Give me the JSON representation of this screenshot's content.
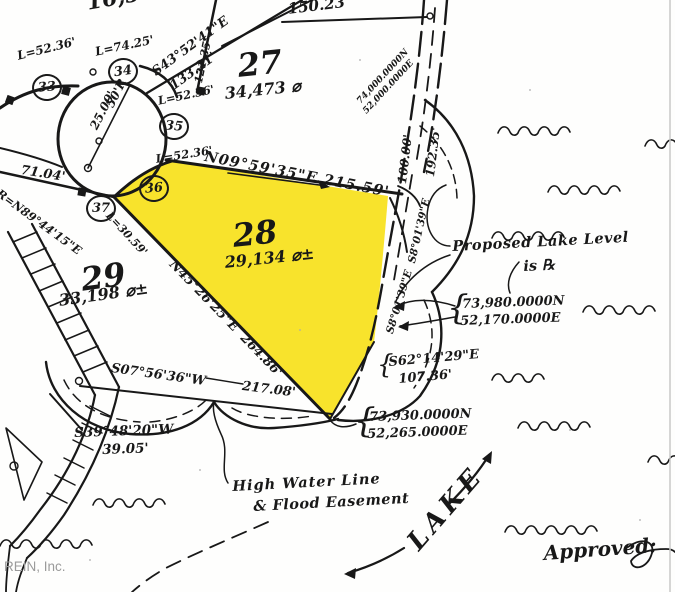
{
  "map": {
    "watermark": "REIN, Inc.",
    "colors": {
      "highlight": "#F8E32C",
      "ink": "#181818",
      "watermark": "#9b9b9b"
    },
    "corner_markers": [
      {
        "num": "33",
        "x": 32,
        "y": 74,
        "rot": -5
      },
      {
        "num": "34",
        "x": 108,
        "y": 58,
        "rot": -8
      },
      {
        "num": "35",
        "x": 159,
        "y": 113,
        "rot": 5
      },
      {
        "num": "36",
        "x": 139,
        "y": 175,
        "rot": -5
      },
      {
        "num": "37",
        "x": 86,
        "y": 195,
        "rot": 0
      }
    ],
    "labels": [
      {
        "name": "lot-area-16503",
        "text": "16,503 ⌀",
        "x": 85,
        "y": -8,
        "rot": -10,
        "size": 22
      },
      {
        "name": "dist-150-23",
        "text": "150.23'",
        "x": 287,
        "y": 2,
        "rot": -7,
        "size": 15
      },
      {
        "name": "lot-27-number",
        "text": "27",
        "x": 236,
        "y": 50,
        "rot": -6,
        "size": 32
      },
      {
        "name": "lot-27-area",
        "text": "34,473 ⌀",
        "x": 224,
        "y": 86,
        "rot": -6,
        "size": 16
      },
      {
        "name": "arc-l-52-36-a",
        "text": "L=52.36'",
        "x": 16,
        "y": 50,
        "rot": -14,
        "size": 12
      },
      {
        "name": "arc-l-74-25",
        "text": "L=74.25'",
        "x": 94,
        "y": 46,
        "rot": -12,
        "size": 12
      },
      {
        "name": "bearing-s43",
        "text": "S43°52'41\"E",
        "x": 150,
        "y": 68,
        "rot": -36,
        "size": 13
      },
      {
        "name": "dist-133-21",
        "text": "133.21'",
        "x": 168,
        "y": 82,
        "rot": -36,
        "size": 13
      },
      {
        "name": "arc-l-52-36-b",
        "text": "L=52.36'",
        "x": 157,
        "y": 96,
        "rot": -12,
        "size": 11.5
      },
      {
        "name": "radius-50r",
        "text": "50'R",
        "x": 104,
        "y": 104,
        "rot": -63,
        "size": 12
      },
      {
        "name": "dist-25-00",
        "text": "25.00'",
        "x": 88,
        "y": 126,
        "rot": -63,
        "size": 12
      },
      {
        "name": "arc-l-52-36-c",
        "text": "L=52.36'",
        "x": 155,
        "y": 154,
        "rot": -9,
        "size": 11.5
      },
      {
        "name": "bearing-n09",
        "text": "N09°59'35\"E 215.59'",
        "x": 206,
        "y": 150,
        "rot": 11,
        "size": 14.5,
        "ls": 1
      },
      {
        "name": "dist-71-04",
        "text": "71.04'",
        "x": 22,
        "y": 164,
        "rot": 9,
        "size": 13
      },
      {
        "name": "bearing-r-n89",
        "text": "R=N89°44'15\"E",
        "x": 1,
        "y": 188,
        "rot": 36,
        "size": 11.5
      },
      {
        "name": "arc-l-30-59",
        "text": "L=30.59'",
        "x": 112,
        "y": 210,
        "rot": 47,
        "size": 11
      },
      {
        "name": "lot-28-number",
        "text": "28",
        "x": 231,
        "y": 220,
        "rot": -6,
        "size": 32
      },
      {
        "name": "lot-28-area",
        "text": "29,134 ⌀±",
        "x": 224,
        "y": 255,
        "rot": -6,
        "size": 16
      },
      {
        "name": "lot-29-number",
        "text": "29",
        "x": 79,
        "y": 264,
        "rot": -8,
        "size": 32
      },
      {
        "name": "lot-29-area",
        "text": "33,198 ⌀±",
        "x": 58,
        "y": 293,
        "rot": -8,
        "size": 16
      },
      {
        "name": "bearing-n45",
        "text": "N45°26'25\"E  264.86'",
        "x": 176,
        "y": 258,
        "rot": 46,
        "size": 13
      },
      {
        "name": "dist-100-00",
        "text": "100.00'",
        "x": 396,
        "y": 183,
        "rot": -83,
        "size": 12
      },
      {
        "name": "dist-192-35",
        "text": "192.35'",
        "x": 424,
        "y": 176,
        "rot": -83,
        "size": 12
      },
      {
        "name": "bearing-s8-a",
        "text": "S8°01'39\"E",
        "x": 407,
        "y": 262,
        "rot": -77,
        "size": 10.5
      },
      {
        "name": "bearing-s8-b",
        "text": "S8°01'39\"E",
        "x": 385,
        "y": 332,
        "rot": -73,
        "size": 10.5
      },
      {
        "name": "coord-74000n",
        "text": "74,000.0000N",
        "x": 356,
        "y": 100,
        "rot": -47,
        "size": 9
      },
      {
        "name": "coord-52000e",
        "text": "52,000.0000E",
        "x": 362,
        "y": 110,
        "rot": -47,
        "size": 9
      },
      {
        "name": "dist-121-35",
        "text": "121.35'",
        "x": 193,
        "y": 82,
        "rot": -78,
        "size": 11
      },
      {
        "name": "note-proposed-lake-1",
        "text": "Proposed Lake Level",
        "x": 452,
        "y": 240,
        "rot": -3,
        "size": 14.5,
        "ls": 0.5
      },
      {
        "name": "note-proposed-lake-2",
        "text": "is ℞",
        "x": 523,
        "y": 260,
        "rot": -3,
        "size": 14.5
      },
      {
        "name": "brace-73980",
        "text": "{",
        "x": 447,
        "y": 291,
        "rot": 0,
        "size": 34,
        "weight": 400
      },
      {
        "name": "coord-73980n",
        "text": "73,980.0000N",
        "x": 462,
        "y": 298,
        "rot": -2,
        "size": 13
      },
      {
        "name": "coord-52170e",
        "text": "52,170.0000E",
        "x": 460,
        "y": 315,
        "rot": -2,
        "size": 13
      },
      {
        "name": "brace-s62",
        "text": "{",
        "x": 377,
        "y": 352,
        "rot": 0,
        "size": 26,
        "weight": 400
      },
      {
        "name": "bearing-s62",
        "text": "S62°14'29\"E",
        "x": 388,
        "y": 356,
        "rot": -5,
        "size": 13
      },
      {
        "name": "dist-107-36",
        "text": "107.36'",
        "x": 398,
        "y": 373,
        "rot": -5,
        "size": 13
      },
      {
        "name": "brace-73930",
        "text": "{",
        "x": 354,
        "y": 404,
        "rot": 0,
        "size": 34,
        "weight": 400
      },
      {
        "name": "coord-73930n",
        "text": "73,930.0000N",
        "x": 369,
        "y": 411,
        "rot": -2,
        "size": 13
      },
      {
        "name": "coord-52265e",
        "text": "52,265.0000E",
        "x": 367,
        "y": 428,
        "rot": -2,
        "size": 13
      },
      {
        "name": "bearing-s07",
        "text": "S07°56'36\"W",
        "x": 112,
        "y": 362,
        "rot": 8,
        "size": 13
      },
      {
        "name": "dist-217-08",
        "text": "217.08'",
        "x": 243,
        "y": 380,
        "rot": 7,
        "size": 13
      },
      {
        "name": "bearing-s39",
        "text": "S39°48'20\"W",
        "x": 74,
        "y": 427,
        "rot": -2,
        "size": 13.5
      },
      {
        "name": "dist-39-05",
        "text": "39.05'",
        "x": 102,
        "y": 444,
        "rot": -2,
        "size": 13.5
      },
      {
        "name": "note-high-water-1",
        "text": "High Water Line",
        "x": 232,
        "y": 480,
        "rot": -3,
        "size": 14.5,
        "ls": 1
      },
      {
        "name": "note-high-water-2",
        "text": "& Flood Easement",
        "x": 253,
        "y": 500,
        "rot": -3,
        "size": 14.5,
        "ls": 0.5
      },
      {
        "name": "lake-label",
        "text": "LAKE",
        "x": 403,
        "y": 538,
        "rot": -49,
        "size": 26,
        "ls": 5
      },
      {
        "name": "approved-label",
        "text": "Approved:",
        "x": 543,
        "y": 543,
        "rot": -4,
        "size": 20
      },
      {
        "name": "rein-watermark",
        "text": "REIN, Inc.",
        "x": 4,
        "y": 560,
        "rot": 0,
        "size": 13.5,
        "color": "#9b9b9b",
        "cls": "sans"
      }
    ]
  }
}
